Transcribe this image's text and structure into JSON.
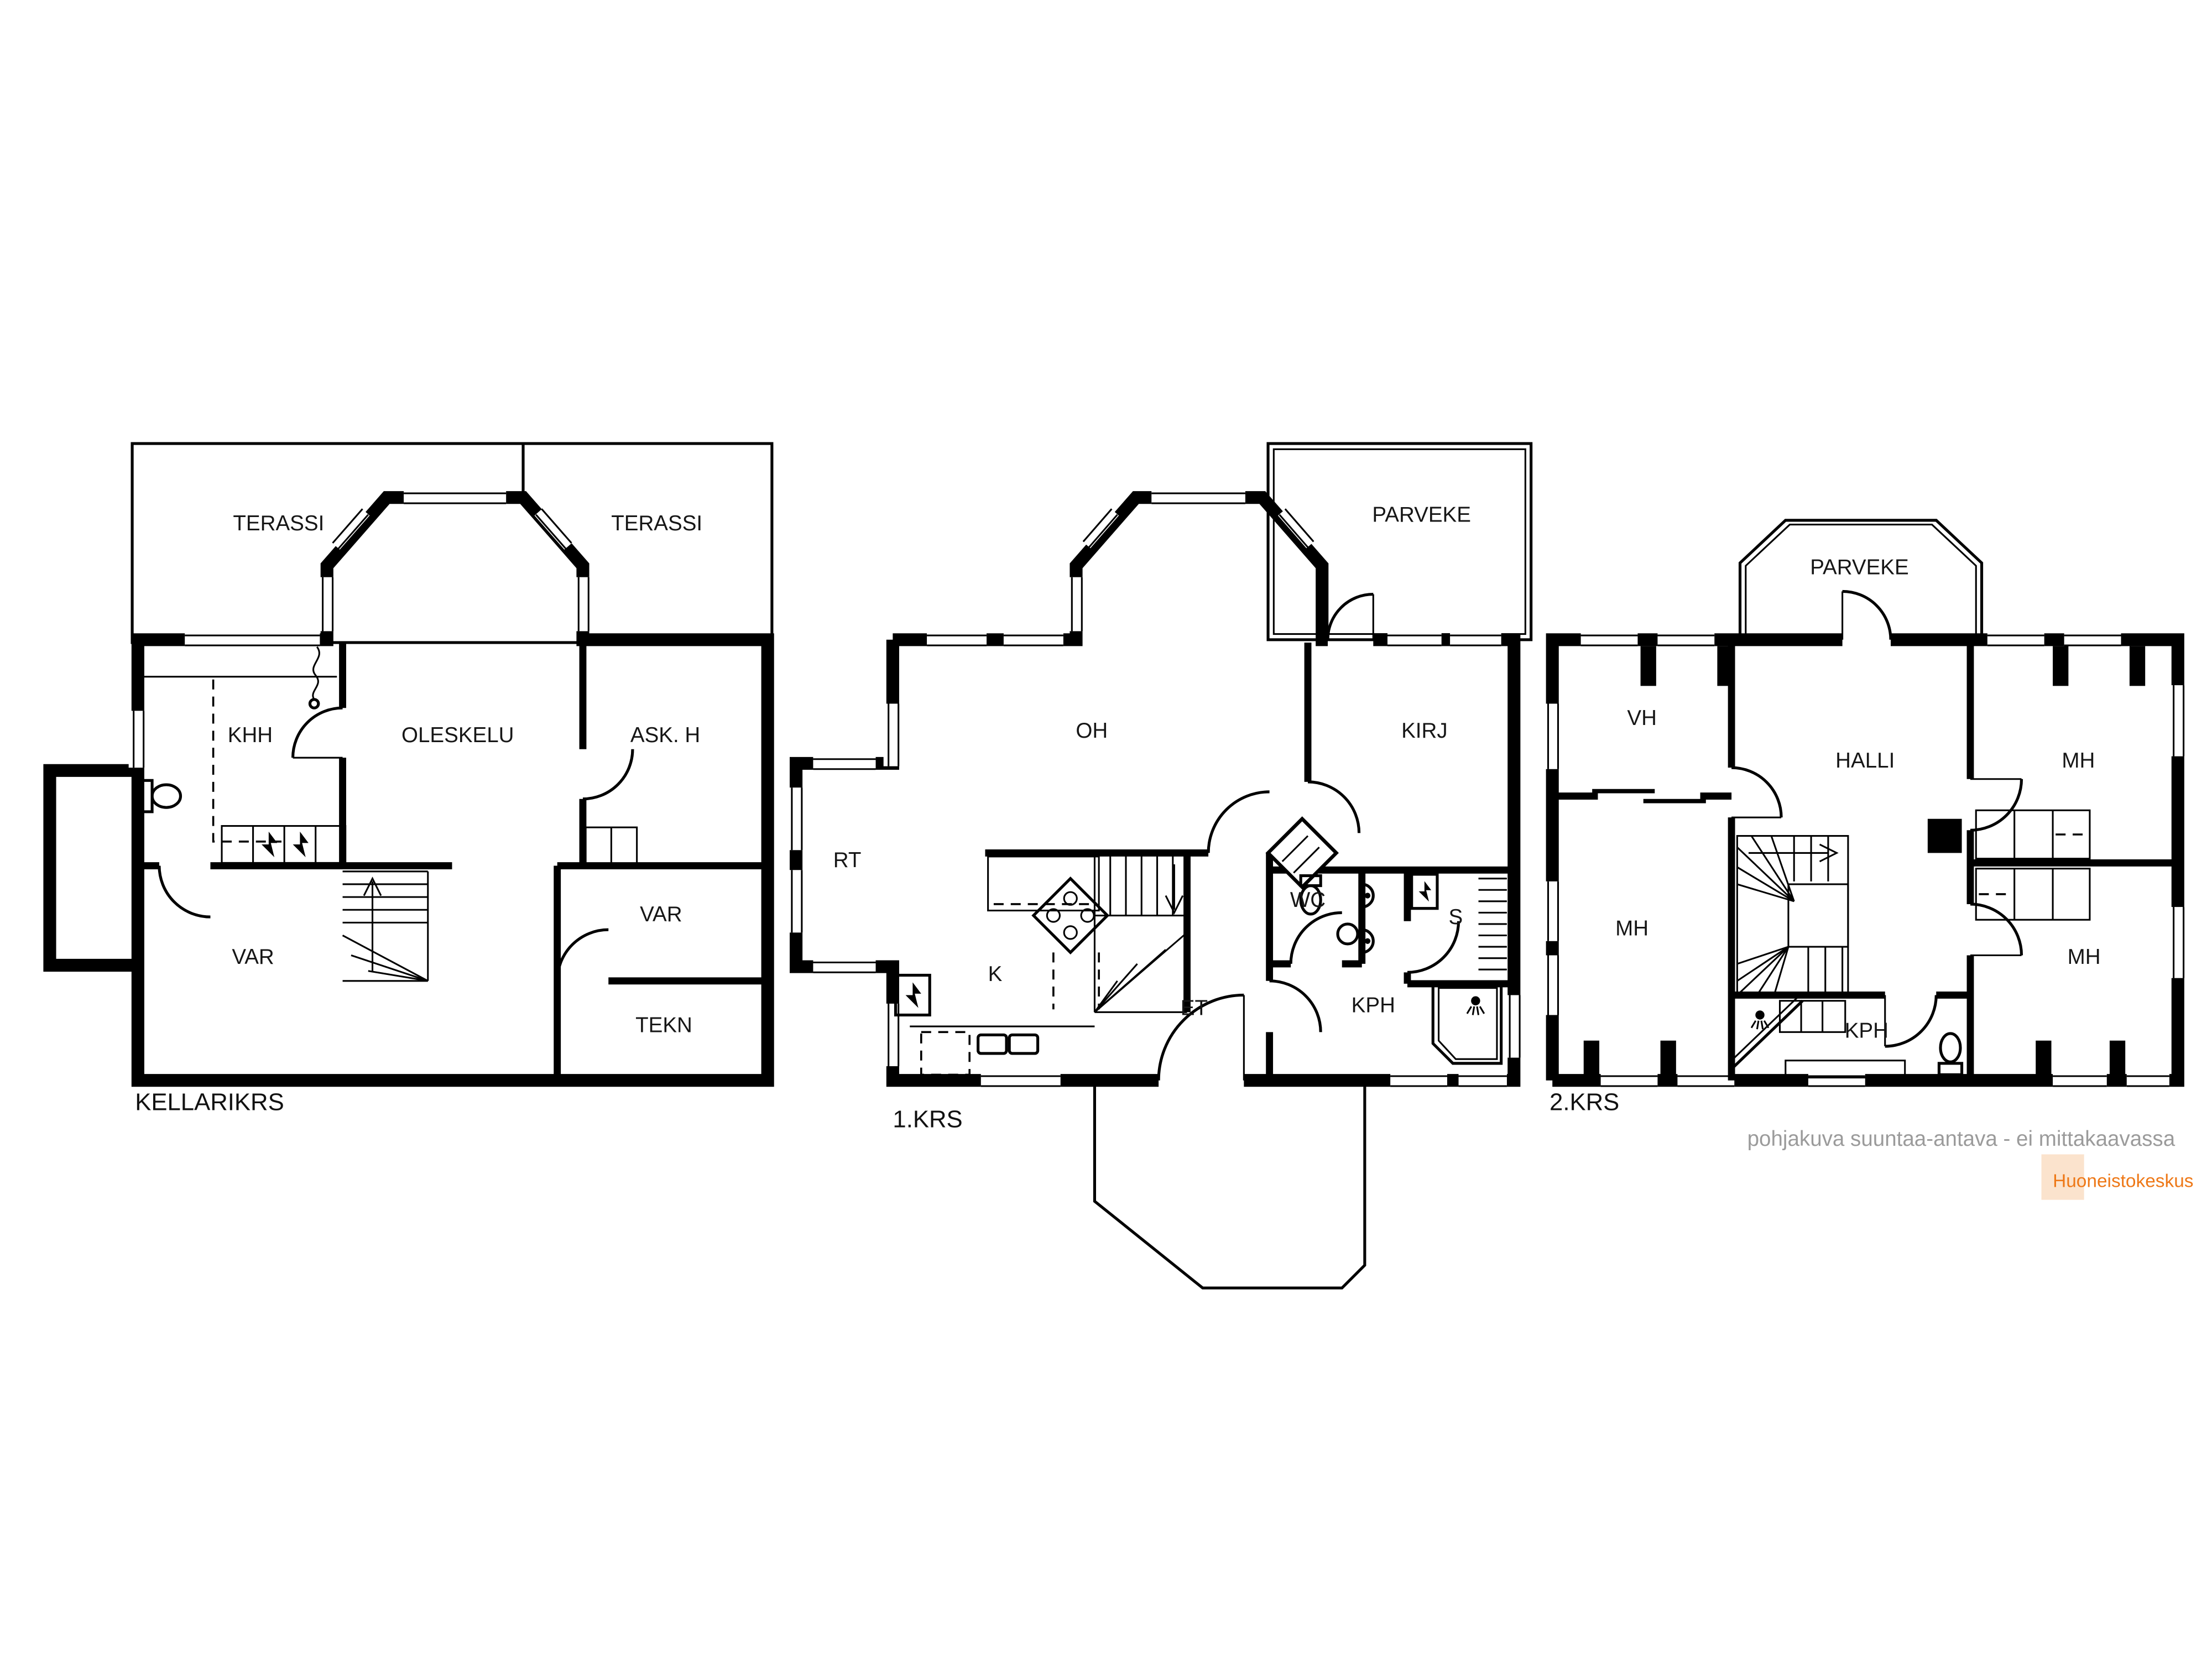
{
  "page": {
    "background": "#ffffff"
  },
  "floors": {
    "basement": {
      "label": "KELLARIKRS",
      "rooms": {
        "terassi_left": "TERASSI",
        "terassi_right": "TERASSI",
        "khh": "KHH",
        "oleskelu": "OLESKELU",
        "ask_h": "ASK. H",
        "var_right": "VAR",
        "var_left": "VAR",
        "tekn": "TEKN"
      }
    },
    "first": {
      "label": "1.KRS",
      "rooms": {
        "parveke": "PARVEKE",
        "oh": "OH",
        "kirj": "KIRJ",
        "rt": "RT",
        "k": "K",
        "et": "ET",
        "wc": "WC",
        "s": "S",
        "kph": "KPH"
      }
    },
    "second": {
      "label": "2.KRS",
      "rooms": {
        "parveke": "PARVEKE",
        "vh": "VH",
        "halli": "HALLI",
        "mh_top": "MH",
        "mh_left": "MH",
        "mh_bottom": "MH",
        "kph": "KPH"
      }
    }
  },
  "footer": {
    "disclaimer": "pohjakuva suuntaa-antava - ei mittakaavassa",
    "disclaimer_color": "#9b9b9b",
    "brand": "Huoneistokeskus",
    "brand_color": "#ee7817",
    "brand_bg": "#fbe3cd"
  },
  "colors": {
    "wall": "#000000",
    "background": "#ffffff"
  }
}
